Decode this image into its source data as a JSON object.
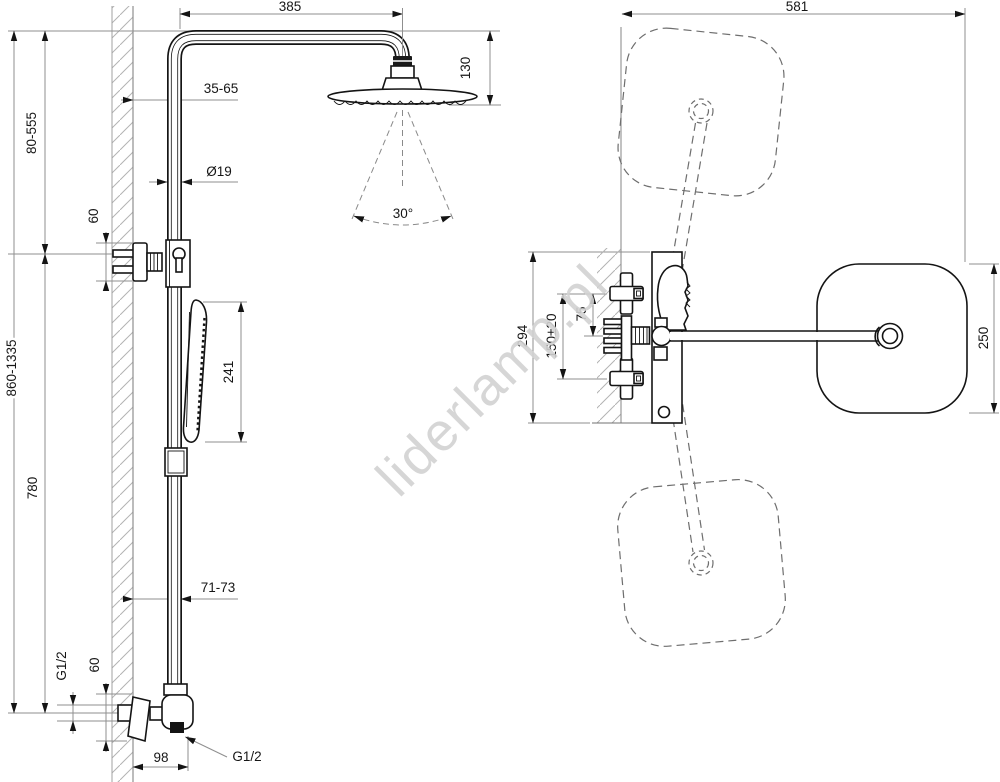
{
  "watermark_text": "liderlamp.pl",
  "colors": {
    "geometry_line": "#141414",
    "dimension_line": "#8f8f8f",
    "hatch": "#b3b3b3",
    "watermark": "#d2d2d2",
    "background": "#ffffff"
  },
  "side_view": {
    "dims": {
      "arm_reach": "385",
      "head_drop": "130",
      "wall_clearance_top": "35-65",
      "pipe_diameter": "Ø19",
      "bracket_height_upper": "60",
      "bracket_travel": "80-555",
      "overall_height": "860-1335",
      "rail_length": "780",
      "spray_angle": "30°",
      "handshower_length": "241",
      "wall_clearance_bottom": "71-73",
      "inlet_thread": "G1/2",
      "bracket_height_lower": "60",
      "valve_depth": "98",
      "outlet_thread": "G1/2"
    }
  },
  "front_view": {
    "dims": {
      "overall_width": "581",
      "body_height": "294",
      "supply_spacing": "150±20",
      "handle_offset": "75",
      "head_width": "250"
    }
  }
}
